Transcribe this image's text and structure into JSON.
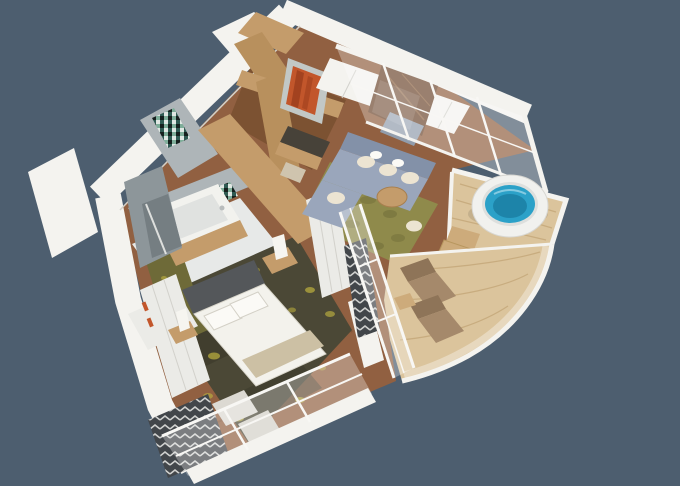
{
  "meta": {
    "width": 680,
    "height": 486,
    "description": "3D isometric cutaway rendering of a hotel suite floor plan with bedroom, living room, bathroom, entry hall, round jacuzzi balcony and curved sun-lounger balcony on a slate blue background"
  },
  "colors": {
    "bg": "#4d5e6f",
    "wall": "#f4f3ef",
    "wallShade": "#eceae4",
    "wallEdge": "#d3d1c9",
    "mullion": "#f8f7f4",
    "seam": "#d2d1cb",
    "floorWood": "#916041",
    "floorStreak": "#6e4527",
    "entryFloor": "#7c5232",
    "woodWardrobe": "#c49c6b",
    "woodBeam": "#b8905d",
    "woodDeck": "#dbc49c",
    "deckLine": "#c3a678",
    "marblePanel": "#6f4a31",
    "marbleVein": "#9a6f4c",
    "tileWall": "#aeb5b8",
    "tileDark": "#8d969a",
    "showerInner": "#757e82",
    "tileFloor": "#e7e9e8",
    "rugOlive": "#8f8a4b",
    "rugOliveDark": "#6e6a38",
    "carpetDark": "#4b4836",
    "carpetShadow": "#3a382a",
    "carpetYellow": "#b5aa3e",
    "sofa": "#9aa6bb",
    "sofaDark": "#8391a8",
    "cushion": "#ece4d2",
    "pillowWhite": "#fbfaf6",
    "bedWhite": "#f3f2ec",
    "runnerBeige": "#ccc0a4",
    "headboard": "#54575a",
    "lampWhite": "#f6f5f0",
    "tub": "#f2f2ee",
    "tubInner": "#e0e2e0",
    "closetWhite": "#ebebe7",
    "glass": "rgba(255,255,255,0.30)",
    "glassLight": "rgba(255,255,255,0.16)",
    "water": "#2ba1c8",
    "waterDeep": "#1d84a9",
    "jacuzziRim": "#f1f1ee",
    "jacuzziInner": "#dddfdd",
    "stepWood": "#cdab7b",
    "lounger": "#a5896b",
    "loungerDark": "#8e7458",
    "curtainDark": "#42464a",
    "curtainLight": "#e9e9e7",
    "artPanel": "#c2c8c6",
    "artOrange": "#c2562b",
    "artDeep": "#8e3517",
    "benchGray": "#919dac",
    "deskDark": "#474239",
    "stoolCream": "#cfc4ae",
    "mosaic1": "#2f5a52",
    "mosaic2": "#e0e7e3",
    "mosaic3": "#16201e",
    "mosaic4": "#7fae9a"
  },
  "scene": {
    "type": "3d-floorplan-render",
    "rooms": [
      {
        "name": "entry-hall",
        "objects": [
          "wood-wardrobe-volume",
          "ceiling-beams",
          "console-desk",
          "stool",
          "orange-artwork"
        ]
      },
      {
        "name": "living-room",
        "objects": [
          "l-shaped-sofa",
          "cream-cushions",
          "round-coffee-table",
          "pouf",
          "marble-tv-panel",
          "olive-rug",
          "glass-facade"
        ]
      },
      {
        "name": "bedroom",
        "objects": [
          "double-bed",
          "white-pillows",
          "beige-foot-runner",
          "dark-headboard",
          "nightstands",
          "table-lamps",
          "patterned-carpet",
          "white-wardrobe",
          "wall-closet"
        ]
      },
      {
        "name": "bathroom",
        "objects": [
          "bathtub",
          "wood-tub-panel",
          "mosaic-tile-strip",
          "walk-in-shower",
          "vanity-sink",
          "gray-tile-walls"
        ]
      },
      {
        "name": "jacuzzi-balcony",
        "objects": [
          "round-jacuzzi",
          "blue-water",
          "wood-steps",
          "timber-deck",
          "white-rim"
        ]
      },
      {
        "name": "lounge-balcony",
        "objects": [
          "sun-lounger",
          "sun-lounger",
          "side-stool",
          "curved-glass-balustrade",
          "timber-deck"
        ]
      },
      {
        "name": "window-walls",
        "objects": [
          "white-mullion-grid",
          "chevron-curtain",
          "chevron-curtain",
          "sheer-glass-panels"
        ]
      }
    ]
  }
}
